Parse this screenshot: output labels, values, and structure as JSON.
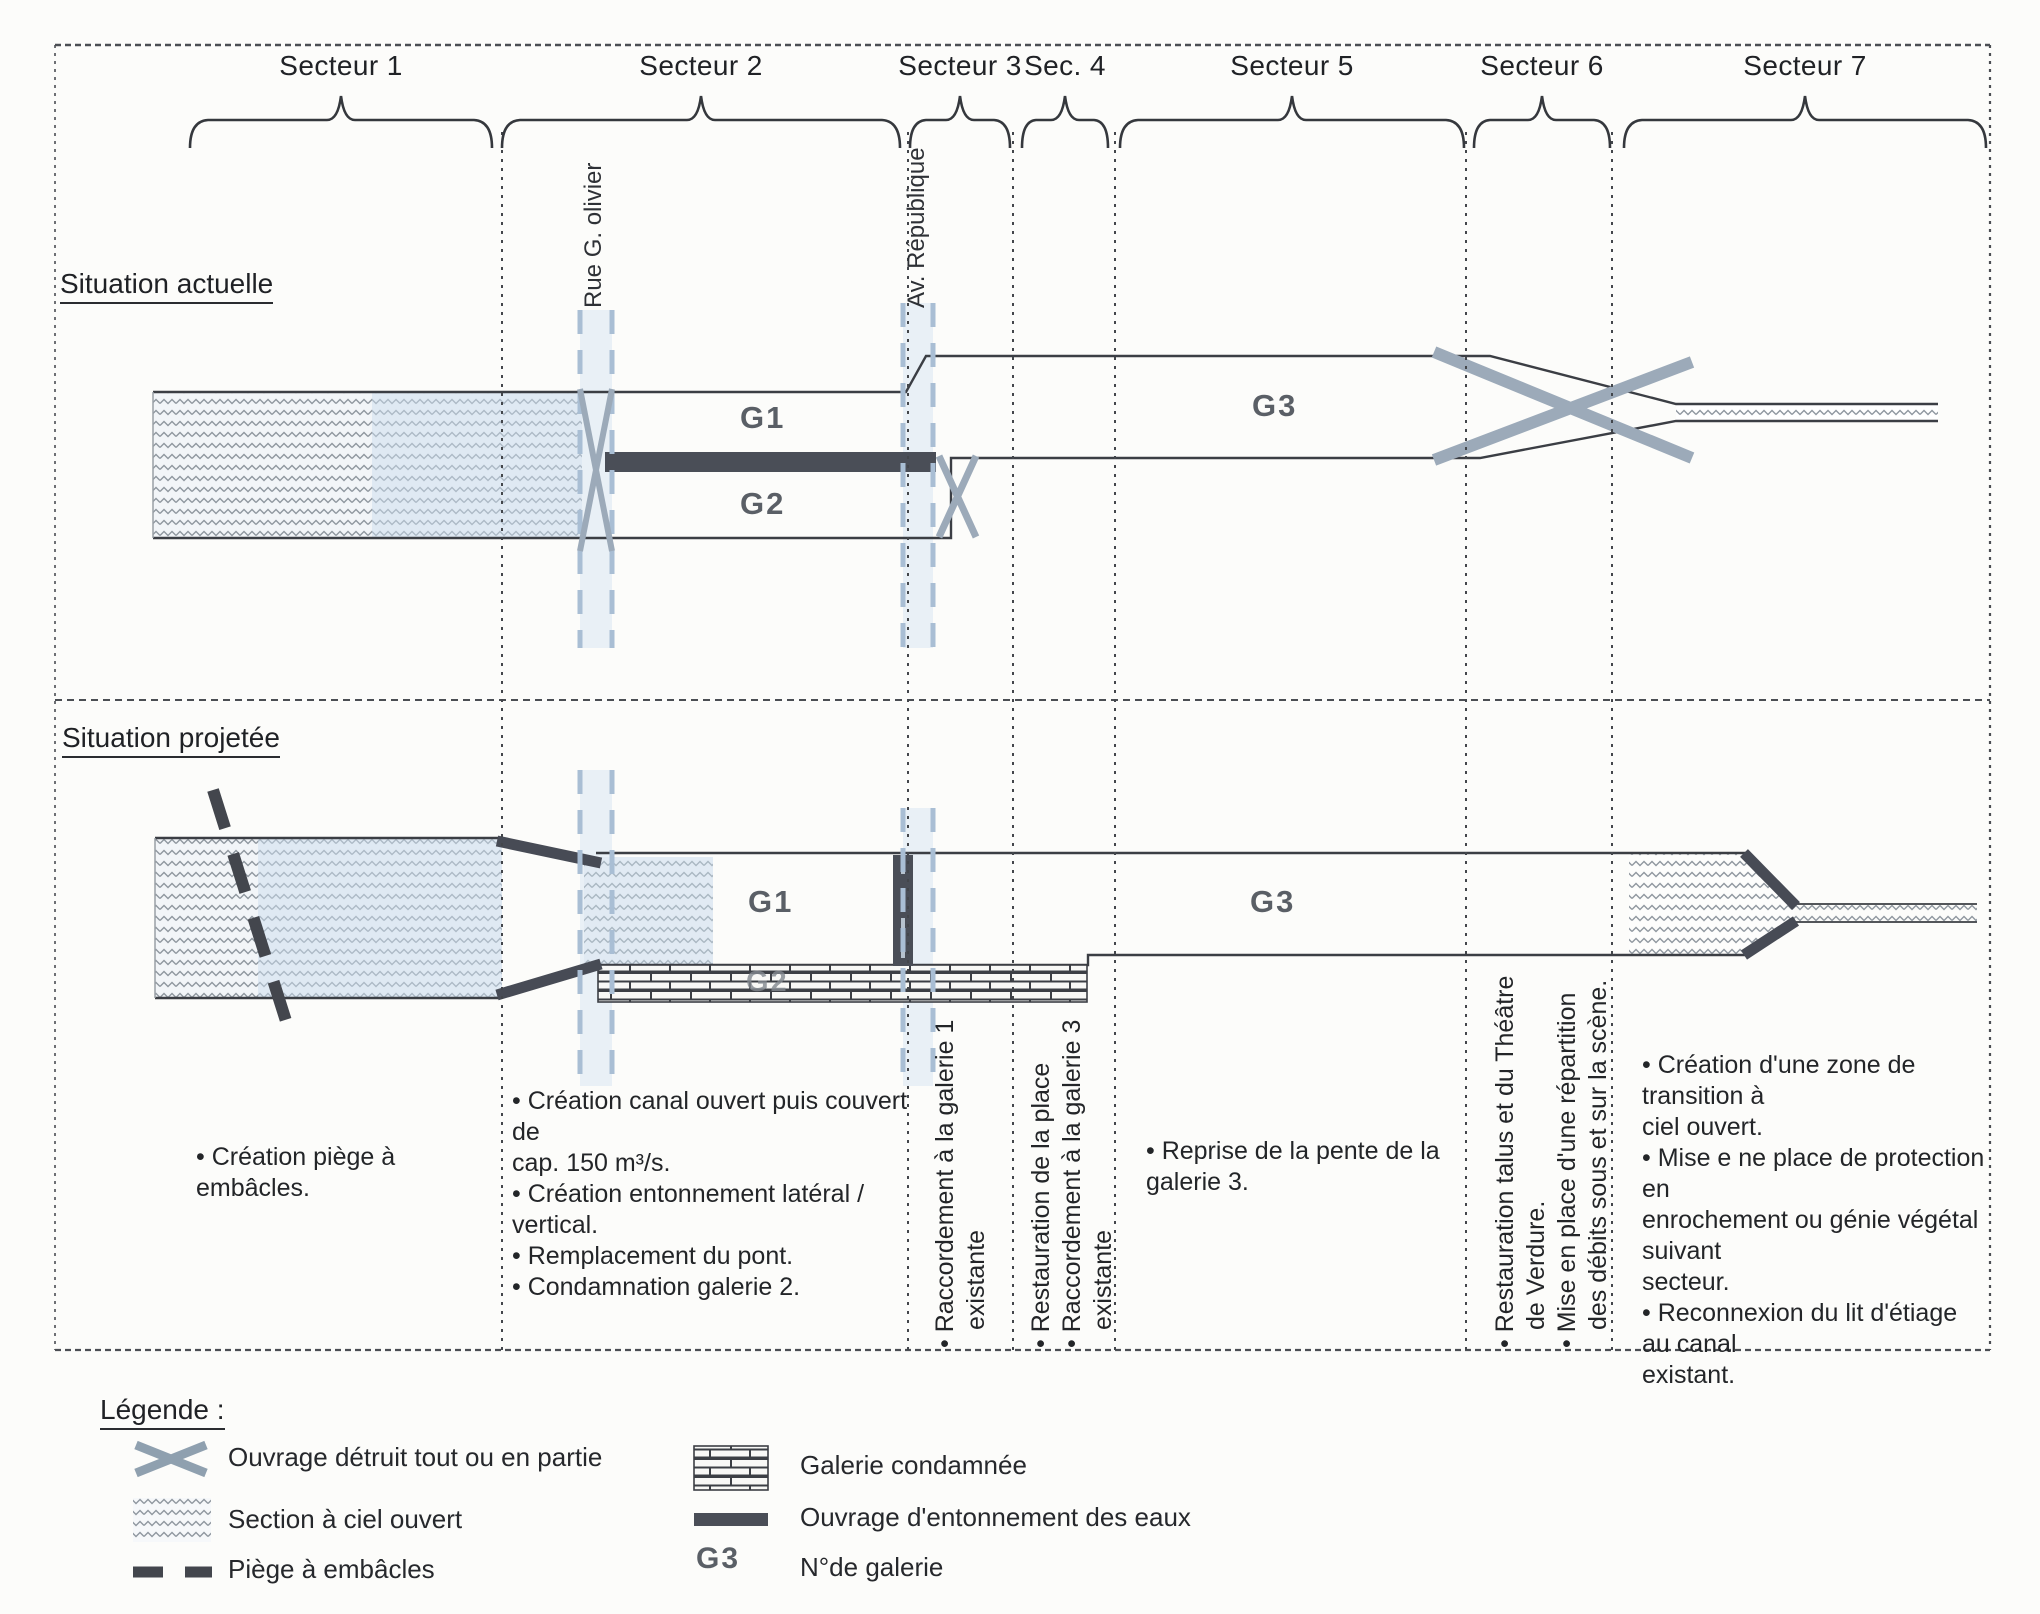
{
  "titles": {
    "current": "Situation actuelle",
    "projected": "Situation projetée"
  },
  "sectors": [
    {
      "label": "Secteur 1"
    },
    {
      "label": "Secteur 2"
    },
    {
      "label": "Secteur 3"
    },
    {
      "label": "Sec. 4"
    },
    {
      "label": "Secteur 5"
    },
    {
      "label": "Secteur 6"
    },
    {
      "label": "Secteur 7"
    }
  ],
  "streets": [
    {
      "name": "Rue G. olivier"
    },
    {
      "name": "Av. République"
    }
  ],
  "galleries": {
    "current": {
      "g1": "G1",
      "g2": "G2",
      "g3": "G3"
    },
    "projected": {
      "g1": "G1",
      "g2": "G2",
      "g3": "G3"
    }
  },
  "annotations": {
    "secteur1": {
      "lines": [
        "• Création piège à embâcles."
      ]
    },
    "secteur2": {
      "lines": [
        "• Création canal ouvert puis couvert de",
        "cap. 150 m³/s.",
        "• Création entonnement latéral / vertical.",
        "• Remplacement du pont.",
        "• Condamnation galerie 2."
      ]
    },
    "secteur3": {
      "lines": [
        "• Raccordement à la galerie 1",
        "existante"
      ]
    },
    "secteur4": {
      "lines": [
        "• Restauration de la place",
        "• Raccordement à la galerie 3",
        "existante"
      ]
    },
    "secteur5": {
      "lines": [
        "• Reprise de la pente de la galerie 3."
      ]
    },
    "secteur6": {
      "lines": [
        "• Restauration talus et du Théâtre",
        "de Verdure.",
        "• Mise en place d'une répartition",
        "des débits sous et sur la scène."
      ]
    },
    "secteur7": {
      "lines": [
        "• Création d'une zone de transition à",
        "ciel ouvert.",
        "• Mise e ne place de protection en",
        "enrochement ou génie végétal suivant",
        "secteur.",
        "• Reconnexion du lit d'étiage au canal",
        "existant."
      ]
    }
  },
  "legend": {
    "title": "Légende :",
    "items": [
      {
        "symbol": "destroyed-structure-x",
        "label": "Ouvrage détruit tout ou en partie"
      },
      {
        "symbol": "open-air-section-hatch",
        "label": "Section à ciel ouvert"
      },
      {
        "symbol": "debris-trap-dash",
        "label": "Piège à embâcles"
      },
      {
        "symbol": "condemned-gallery-brick",
        "label": "Galerie condamnée"
      },
      {
        "symbol": "water-intake-bar",
        "label": "Ouvrage d'entonnement des eaux"
      },
      {
        "symbol": "gallery-number",
        "swatch_text": "G3",
        "label": "N°de galerie"
      }
    ]
  },
  "colors": {
    "street_blue": "#a9bed4",
    "street_wash": "#d9e6f2",
    "dark_structure": "#4a4e57",
    "destroyed_x_gray": "#9caab9",
    "line_dark": "#3b3e44",
    "text": "#26282c"
  }
}
